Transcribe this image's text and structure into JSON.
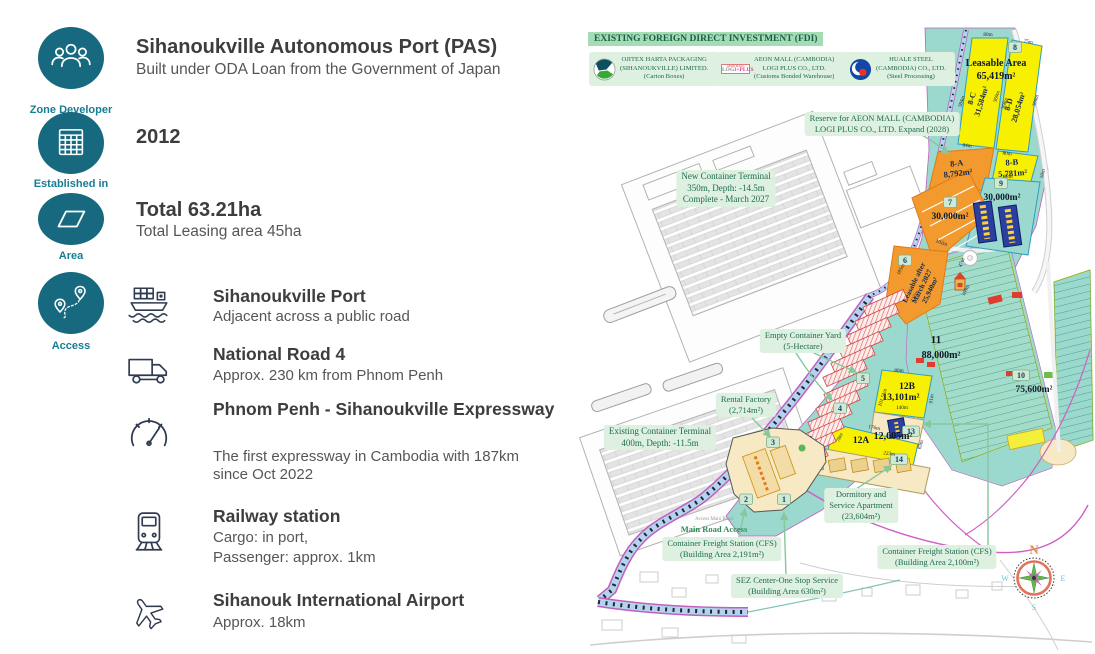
{
  "left_panel": {
    "categories": [
      {
        "label": "Zone Developer"
      },
      {
        "label": "Established in"
      },
      {
        "label": "Area"
      },
      {
        "label": "Access"
      }
    ],
    "developer": {
      "title": "Sihanoukville Autonomous Port (PAS)",
      "subtitle": "Built under ODA Loan from the Government of Japan"
    },
    "established_value": "2012",
    "area": {
      "title": "Total 63.21ha",
      "subtitle": "Total Leasing area 45ha"
    },
    "access_items": [
      {
        "icon": "cargo-ship",
        "title": "Sihanoukville Port",
        "lines": [
          "Adjacent across a public road"
        ]
      },
      {
        "icon": "truck",
        "title": "National Road 4",
        "lines": [
          "Approx. 230 km from Phnom Penh"
        ]
      },
      {
        "icon": "speedometer",
        "title": "Phnom Penh - Sihanoukville Expressway",
        "lines": [
          "The first expressway in Cambodia with 187km",
          "since Oct 2022"
        ]
      },
      {
        "icon": "train",
        "title": "Railway station",
        "lines": [
          "Cargo: in port,",
          "Passenger: approx. 1km"
        ]
      },
      {
        "icon": "airplane",
        "title": "Sihanouk International Airport",
        "lines": [
          "Approx. 18km"
        ]
      }
    ]
  },
  "map": {
    "fdi": {
      "title": "EXISTING FOREIGN DIRECT INVESTMENT (FDI)",
      "companies": [
        {
          "l1": "OJITEX HARTA PACKAGING",
          "l2": "(SIHANOUKVILLE) LIMITED.",
          "l3": "(Carton Boxes)"
        },
        {
          "l1": "AEON MALL (CAMBODIA)",
          "l2": "LOGI PLUS CO., LTD.",
          "l3": "(Customs Bonded Warehouse)",
          "logo_top": "AEON MALL",
          "logo_l": "LOGI",
          "logo_r": "+PLUS"
        },
        {
          "l1": "HUALE STEEL",
          "l2": "(CAMBODIA) CO., LTD.",
          "l3": "(Steel Processing)"
        }
      ]
    },
    "labels": {
      "new_terminal": {
        "l1": "New Container Terminal",
        "l2": "350m, Depth: -14.5m",
        "l3": "Complete - March 2027"
      },
      "reserve": {
        "l1": "Reserve for AEON MALL (CAMBODIA)",
        "l2": "LOGI PLUS CO., LTD. Expand (2028)"
      },
      "empty_yard": {
        "l1": "Empty Container Yard",
        "l2": "(5-Hectare)"
      },
      "rental": {
        "l1": "Rental Factory",
        "l2": "(2,714m²)"
      },
      "existing_terminal": {
        "l1": "Existing Container Terminal",
        "l2": "400m, Depth: -11.5m"
      },
      "dormitory": {
        "l1": "Dormitory and",
        "l2": "Service Apartment",
        "l3": "(23,604m²)"
      },
      "access_main_road_small": "Access Main Road",
      "main_road_access": "Main Road Access",
      "cfs1": {
        "l1": "Container Freight Station (CFS)",
        "l2": "(Building Area 2,191m²)"
      },
      "sez_center": {
        "l1": "SEZ Center-One Stop Service",
        "l2": "(Building Area 630m²)"
      },
      "cfs2": {
        "l1": "Container Freight Station (CFS)",
        "l2": "(Building Area 2,100m²)"
      }
    },
    "zones": {
      "z8": {
        "badge": "8",
        "line1": "Leasable Area",
        "line2": "65,419m²"
      },
      "z8c": {
        "id": "8-C",
        "area": "31,584m²"
      },
      "z8d": {
        "id": "8-D",
        "area": "28,054m²"
      },
      "z8a": {
        "id": "8-A",
        "area": "8,792m²"
      },
      "z8b": {
        "id": "8-B",
        "area": "5,781m²"
      },
      "z9": {
        "badge": "9",
        "area": "30,000m²"
      },
      "z7": {
        "badge": "7",
        "area": "30,000m²"
      },
      "z6": {
        "badge": "6",
        "line1": "Leasable after",
        "line2": "March 2027",
        "line3": "25,940m²"
      },
      "z11": {
        "id": "11",
        "area": "88,000m²"
      },
      "z10": {
        "badge": "10",
        "area": "75,600m²"
      },
      "z12b": {
        "id": "12B",
        "area": "13,101m²"
      },
      "z12a": {
        "id": "12A",
        "area": "12,605m²"
      },
      "b1": "1",
      "b2": "2",
      "b3": "3",
      "b4": "4",
      "b5": "5",
      "b13": "13",
      "b14": "14"
    },
    "measurements": [
      "80m",
      "75m",
      "384m",
      "360m",
      "368m",
      "366m",
      "84m",
      "80m",
      "88m",
      "58m",
      "102m",
      "47m",
      "185m",
      "122m",
      "169m",
      "80m",
      "101.51m",
      "140m",
      "91m",
      "176m",
      "223m",
      "78m",
      "63m"
    ],
    "compass": {
      "n": "N",
      "e": "E",
      "s": "S",
      "w": "W"
    },
    "colors": {
      "land_teal": "#9bd8cd",
      "parcel_yellow": "#f7f000",
      "parcel_orange": "#f29a2e",
      "label_green_bg": "#def0df",
      "road_magenta": "#c05fc0",
      "building_blue": "#2b3f9e",
      "factory_red": "#dd6a5e",
      "icon_teal": "#17697f"
    }
  }
}
